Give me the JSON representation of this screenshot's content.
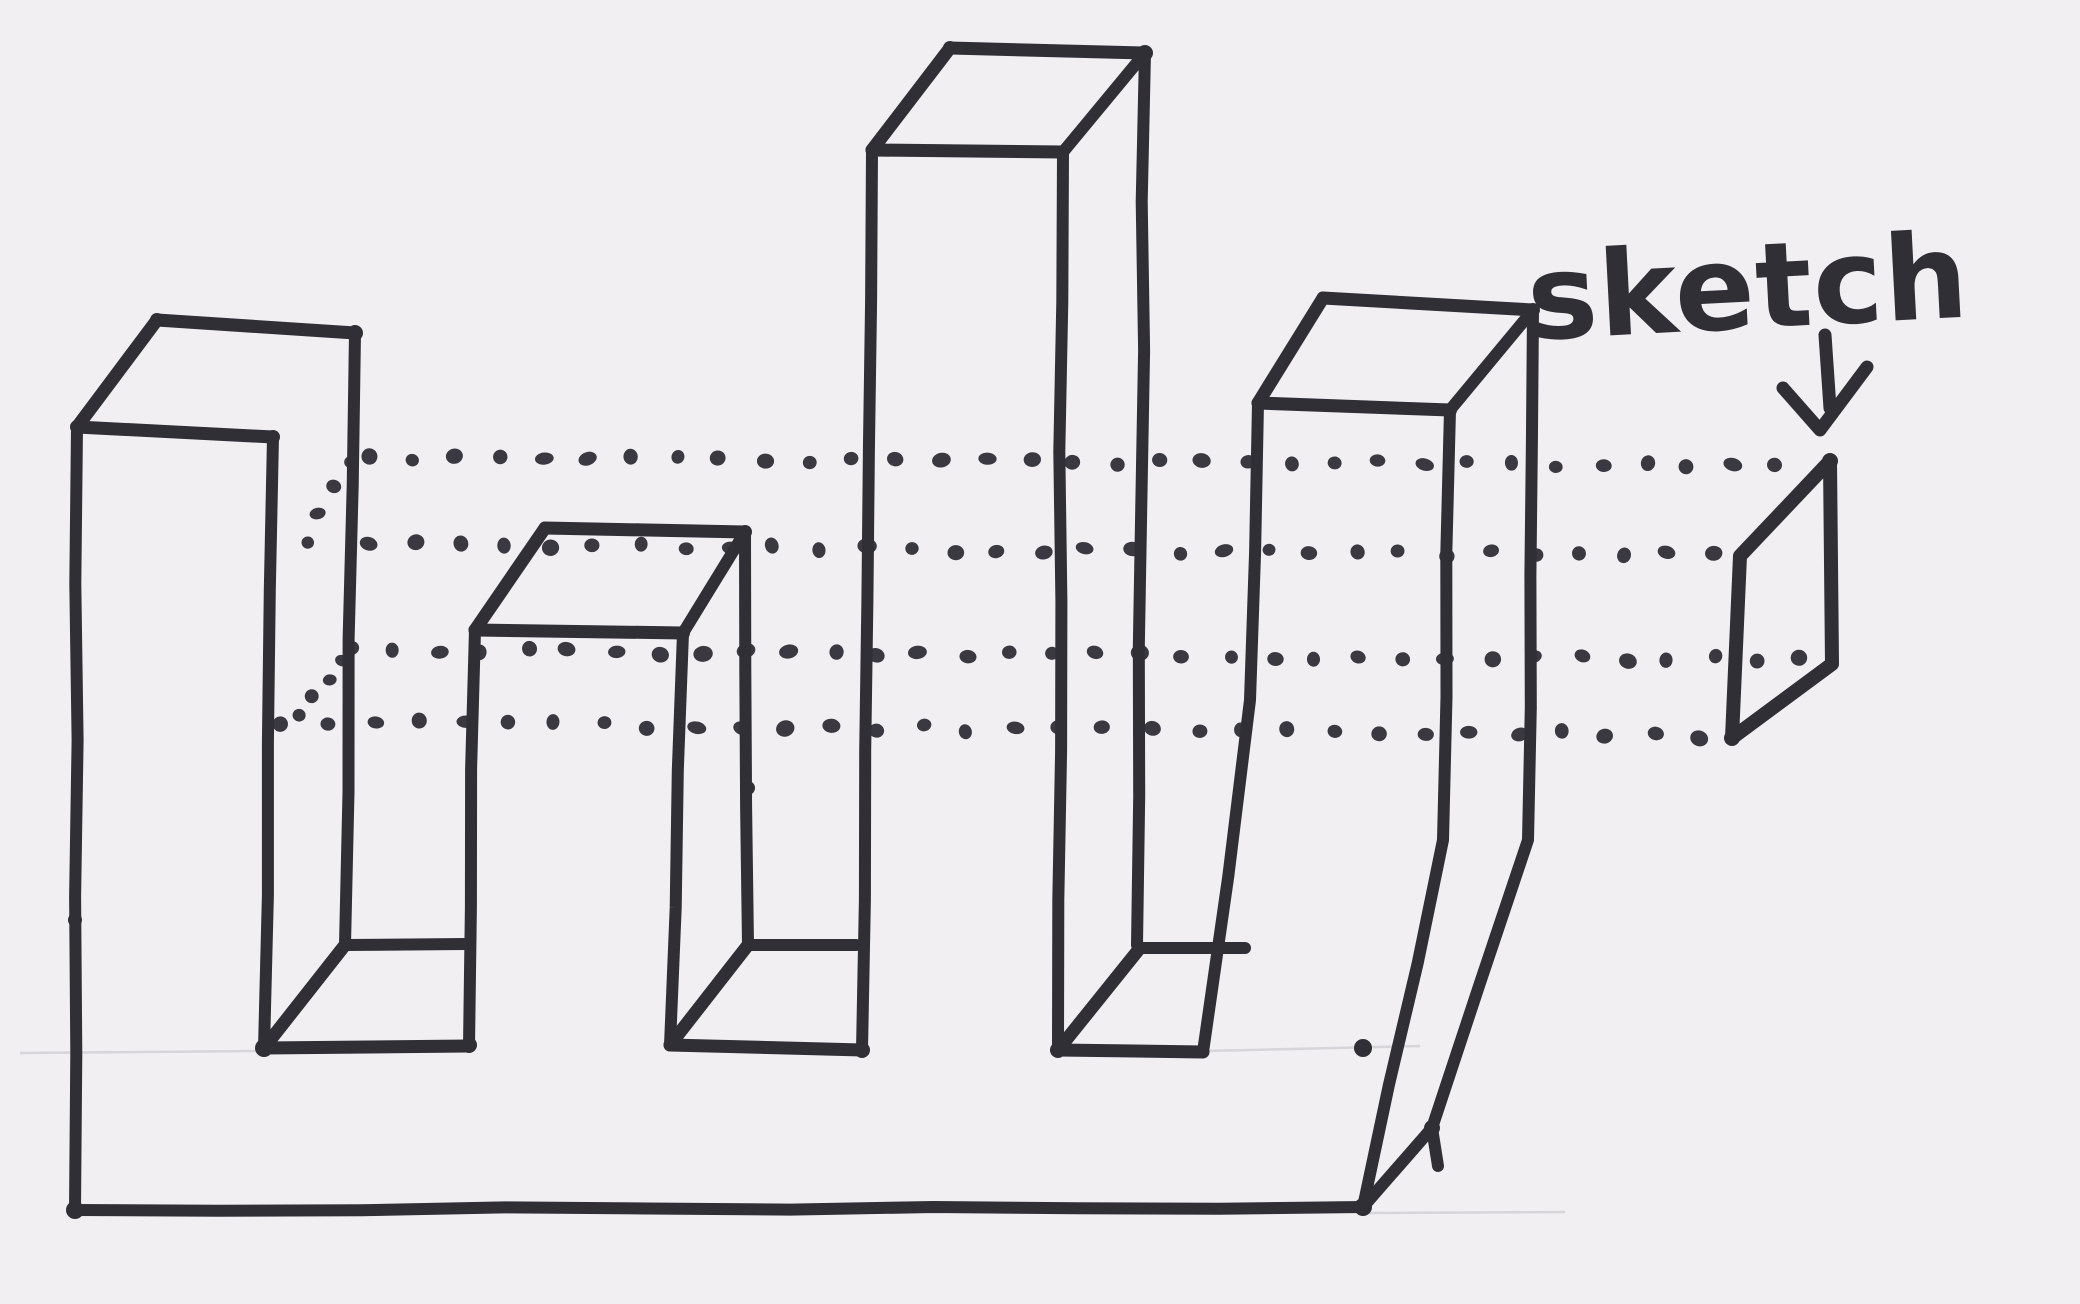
{
  "sketch_label": {
    "text": "sketch"
  },
  "colors": {
    "ink": "#302f36",
    "dot_ink": "#3a3941",
    "paper": "#f1eff2",
    "pencil": "#d7d4da"
  },
  "drawing": {
    "description": "hand-drawn marker diagram of a crenellated solid extruded from a small rectangular sketch profile",
    "faces": [
      {
        "name": "col1-top-face",
        "points": [
          [
            77,
            427
          ],
          [
            157,
            320
          ],
          [
            355,
            333
          ],
          [
            273,
            437
          ]
        ]
      },
      {
        "name": "col1-right-side-face",
        "points": [
          [
            273,
            437
          ],
          [
            355,
            333
          ],
          [
            345,
            945
          ],
          [
            264,
            1048
          ]
        ]
      },
      {
        "name": "col2-top-face",
        "points": [
          [
            475,
            630
          ],
          [
            545,
            528
          ],
          [
            745,
            532
          ],
          [
            683,
            633
          ]
        ]
      },
      {
        "name": "col2-right-side-face",
        "points": [
          [
            683,
            633
          ],
          [
            745,
            532
          ],
          [
            748,
            945
          ],
          [
            670,
            1045
          ]
        ]
      },
      {
        "name": "col3-top-face",
        "points": [
          [
            872,
            150
          ],
          [
            950,
            48
          ],
          [
            1145,
            53
          ],
          [
            1063,
            152
          ]
        ]
      },
      {
        "name": "col3-right-side-face",
        "points": [
          [
            1063,
            152
          ],
          [
            1145,
            53
          ],
          [
            1137,
            945
          ],
          [
            1058,
            1050
          ]
        ]
      },
      {
        "name": "col4-top-face",
        "points": [
          [
            1258,
            403
          ],
          [
            1323,
            298
          ],
          [
            1533,
            310
          ],
          [
            1450,
            410
          ]
        ]
      },
      {
        "name": "col4-right-side-face",
        "points": [
          [
            1450,
            410
          ],
          [
            1533,
            310
          ],
          [
            1528,
            840
          ],
          [
            1432,
            1128
          ],
          [
            1363,
            1207
          ],
          [
            1443,
            840
          ]
        ]
      },
      {
        "name": "front-face",
        "points": [
          [
            77,
            427
          ],
          [
            273,
            437
          ],
          [
            264,
            1048
          ],
          [
            469,
            1046
          ],
          [
            475,
            630
          ],
          [
            683,
            633
          ],
          [
            670,
            1045
          ],
          [
            862,
            1050
          ],
          [
            872,
            150
          ],
          [
            1063,
            152
          ],
          [
            1058,
            1050
          ],
          [
            1203,
            1052
          ],
          [
            1258,
            403
          ],
          [
            1450,
            410
          ],
          [
            1443,
            840
          ],
          [
            1363,
            1207
          ],
          [
            75,
            1210
          ]
        ]
      },
      {
        "name": "notch1-bottom-face",
        "points": [
          [
            264,
            1048
          ],
          [
            345,
            945
          ],
          [
            466,
            944
          ],
          [
            469,
            1046
          ]
        ]
      },
      {
        "name": "notch2-bottom-face",
        "points": [
          [
            670,
            1045
          ],
          [
            748,
            945
          ],
          [
            856,
            945
          ],
          [
            862,
            1050
          ]
        ]
      },
      {
        "name": "notch3-bottom-face",
        "points": [
          [
            1058,
            1050
          ],
          [
            1140,
            948
          ],
          [
            1245,
            948
          ],
          [
            1203,
            1052
          ]
        ]
      }
    ],
    "strokes": [
      {
        "name": "col1-front-left-edge",
        "w": 12,
        "points": [
          [
            77,
            427
          ],
          [
            75,
            1210
          ]
        ]
      },
      {
        "name": "base-front-bottom-edge",
        "w": 12,
        "points": [
          [
            75,
            1210
          ],
          [
            1363,
            1207
          ]
        ]
      },
      {
        "name": "col1-front-top-edge",
        "w": 13,
        "points": [
          [
            77,
            427
          ],
          [
            273,
            437
          ]
        ]
      },
      {
        "name": "col1-front-right-edge",
        "w": 12,
        "points": [
          [
            273,
            437
          ],
          [
            264,
            1048
          ]
        ]
      },
      {
        "name": "notch1-front-bottom-edge",
        "w": 13,
        "points": [
          [
            264,
            1048
          ],
          [
            469,
            1046
          ]
        ]
      },
      {
        "name": "col2-front-left-edge",
        "w": 12,
        "points": [
          [
            469,
            1046
          ],
          [
            475,
            630
          ]
        ]
      },
      {
        "name": "col2-front-top-edge",
        "w": 13,
        "points": [
          [
            475,
            630
          ],
          [
            683,
            633
          ]
        ]
      },
      {
        "name": "col2-front-right-edge",
        "w": 12,
        "points": [
          [
            683,
            633
          ],
          [
            670,
            1045
          ]
        ]
      },
      {
        "name": "notch2-front-bottom-edge",
        "w": 13,
        "points": [
          [
            670,
            1045
          ],
          [
            862,
            1050
          ]
        ]
      },
      {
        "name": "col3-front-left-edge",
        "w": 12,
        "points": [
          [
            862,
            1050
          ],
          [
            872,
            150
          ]
        ]
      },
      {
        "name": "col3-front-top-edge",
        "w": 13,
        "points": [
          [
            872,
            150
          ],
          [
            1063,
            152
          ]
        ]
      },
      {
        "name": "col3-front-right-edge",
        "w": 12,
        "points": [
          [
            1063,
            152
          ],
          [
            1058,
            1050
          ]
        ]
      },
      {
        "name": "notch3-front-bottom-edge",
        "w": 13,
        "points": [
          [
            1058,
            1050
          ],
          [
            1203,
            1052
          ]
        ]
      },
      {
        "name": "col4-front-left-edge",
        "w": 12,
        "points": [
          [
            1203,
            1052
          ],
          [
            1250,
            700
          ],
          [
            1258,
            403
          ]
        ]
      },
      {
        "name": "col4-front-top-edge",
        "w": 13,
        "points": [
          [
            1258,
            403
          ],
          [
            1450,
            410
          ]
        ]
      },
      {
        "name": "col4-front-right-edge",
        "w": 12,
        "points": [
          [
            1450,
            410
          ],
          [
            1443,
            840
          ],
          [
            1363,
            1207
          ]
        ]
      },
      {
        "name": "base-right-depth-edge",
        "w": 12,
        "points": [
          [
            1363,
            1207
          ],
          [
            1432,
            1128
          ]
        ]
      },
      {
        "name": "col1-top-left-depth-edge",
        "w": 13,
        "points": [
          [
            77,
            427
          ],
          [
            157,
            320
          ]
        ]
      },
      {
        "name": "col1-top-back-edge",
        "w": 13,
        "points": [
          [
            157,
            320
          ],
          [
            355,
            333
          ]
        ]
      },
      {
        "name": "col1-back-right-edge",
        "w": 12,
        "points": [
          [
            355,
            333
          ],
          [
            345,
            945
          ]
        ]
      },
      {
        "name": "notch1-bottom-depth-edge",
        "w": 13,
        "points": [
          [
            264,
            1048
          ],
          [
            345,
            945
          ]
        ]
      },
      {
        "name": "notch1-back-bottom-edge",
        "w": 12,
        "points": [
          [
            345,
            945
          ],
          [
            466,
            944
          ]
        ]
      },
      {
        "name": "col2-top-left-depth-edge",
        "w": 13,
        "points": [
          [
            475,
            630
          ],
          [
            545,
            528
          ]
        ]
      },
      {
        "name": "col2-top-back-edge",
        "w": 13,
        "points": [
          [
            545,
            528
          ],
          [
            745,
            532
          ]
        ]
      },
      {
        "name": "col2-top-right-depth-edge",
        "w": 12,
        "points": [
          [
            683,
            633
          ],
          [
            745,
            532
          ]
        ]
      },
      {
        "name": "col2-back-right-edge",
        "w": 12,
        "points": [
          [
            745,
            532
          ],
          [
            748,
            945
          ]
        ]
      },
      {
        "name": "notch2-bottom-depth-edge",
        "w": 13,
        "points": [
          [
            670,
            1045
          ],
          [
            748,
            945
          ]
        ]
      },
      {
        "name": "notch2-back-bottom-edge",
        "w": 12,
        "points": [
          [
            748,
            945
          ],
          [
            856,
            945
          ]
        ]
      },
      {
        "name": "col3-top-left-depth-edge",
        "w": 13,
        "points": [
          [
            872,
            150
          ],
          [
            950,
            48
          ]
        ]
      },
      {
        "name": "col3-top-back-edge",
        "w": 13,
        "points": [
          [
            950,
            48
          ],
          [
            1145,
            53
          ]
        ]
      },
      {
        "name": "col3-top-right-depth-edge",
        "w": 12,
        "points": [
          [
            1063,
            152
          ],
          [
            1145,
            53
          ]
        ]
      },
      {
        "name": "col3-back-right-edge",
        "w": 12,
        "points": [
          [
            1145,
            53
          ],
          [
            1137,
            945
          ]
        ]
      },
      {
        "name": "notch3-bottom-depth-edge",
        "w": 13,
        "points": [
          [
            1058,
            1050
          ],
          [
            1140,
            948
          ]
        ]
      },
      {
        "name": "notch3-back-bottom-edge",
        "w": 12,
        "points": [
          [
            1140,
            948
          ],
          [
            1245,
            948
          ]
        ]
      },
      {
        "name": "col4-top-left-depth-edge",
        "w": 13,
        "points": [
          [
            1258,
            403
          ],
          [
            1323,
            298
          ]
        ]
      },
      {
        "name": "col4-top-back-edge",
        "w": 13,
        "points": [
          [
            1323,
            298
          ],
          [
            1533,
            310
          ]
        ]
      },
      {
        "name": "col4-top-right-depth-edge",
        "w": 12,
        "points": [
          [
            1450,
            410
          ],
          [
            1533,
            310
          ]
        ]
      },
      {
        "name": "col4-back-right-edge",
        "w": 12,
        "points": [
          [
            1533,
            310
          ],
          [
            1528,
            840
          ],
          [
            1432,
            1128
          ],
          [
            1438,
            1166
          ]
        ]
      }
    ],
    "blobs": [
      [
        75,
        920,
        7
      ],
      [
        75,
        1210,
        9
      ],
      [
        77,
        427,
        7
      ],
      [
        157,
        320,
        7
      ],
      [
        273,
        437,
        7
      ],
      [
        355,
        333,
        8
      ],
      [
        264,
        1048,
        9
      ],
      [
        469,
        1045,
        8
      ],
      [
        683,
        633,
        7
      ],
      [
        745,
        532,
        7
      ],
      [
        748,
        788,
        7
      ],
      [
        862,
        1050,
        8
      ],
      [
        950,
        48,
        7
      ],
      [
        1145,
        53,
        8
      ],
      [
        1058,
        1050,
        8
      ],
      [
        1140,
        948,
        7
      ],
      [
        1363,
        1048,
        9
      ],
      [
        1363,
        1207,
        9
      ],
      [
        1450,
        410,
        7
      ],
      [
        1533,
        310,
        7
      ],
      [
        1432,
        1128,
        8
      ],
      [
        1830,
        461,
        8
      ],
      [
        1732,
        738,
        8
      ]
    ],
    "dot_rows": [
      {
        "name": "projection-row-1",
        "from": [
          368,
          457
        ],
        "to": [
          1777,
          465
        ],
        "spacing": 44,
        "r": 7.5
      },
      {
        "name": "projection-row-2",
        "from": [
          370,
          544
        ],
        "to": [
          1715,
          556
        ],
        "spacing": 45,
        "r": 7.5
      },
      {
        "name": "projection-row-3",
        "from": [
          350,
          650
        ],
        "to": [
          1800,
          660
        ],
        "spacing": 44,
        "r": 7.5
      },
      {
        "name": "projection-row-4",
        "from": [
          282,
          722
        ],
        "to": [
          1700,
          735
        ],
        "spacing": 46,
        "r": 7.5
      },
      {
        "name": "hidden-profile-depth-edge-top",
        "from": [
          352,
          463
        ],
        "to": [
          306,
          540
        ],
        "spacing": 26,
        "r": 6.5
      },
      {
        "name": "hidden-profile-depth-edge-bottom",
        "from": [
          345,
          661
        ],
        "to": [
          299,
          717
        ],
        "spacing": 26,
        "r": 6.5
      }
    ],
    "pencil_lines": [
      [
        20,
        1053,
        262,
        1051
      ],
      [
        1205,
        1051,
        1420,
        1046
      ],
      [
        1368,
        1213,
        1565,
        1212
      ]
    ],
    "sketch_profile": {
      "name": "sketch-profile-rectangle",
      "w": 14,
      "points": [
        [
          1830,
          461
        ],
        [
          1740,
          556
        ],
        [
          1732,
          738
        ],
        [
          1832,
          664
        ]
      ]
    },
    "arrow": {
      "shaft": [
        [
          1825,
          335
        ],
        [
          1830,
          408
        ]
      ],
      "head": [
        [
          1783,
          388
        ],
        [
          1820,
          430
        ],
        [
          1867,
          367
        ]
      ],
      "w": 13
    }
  }
}
